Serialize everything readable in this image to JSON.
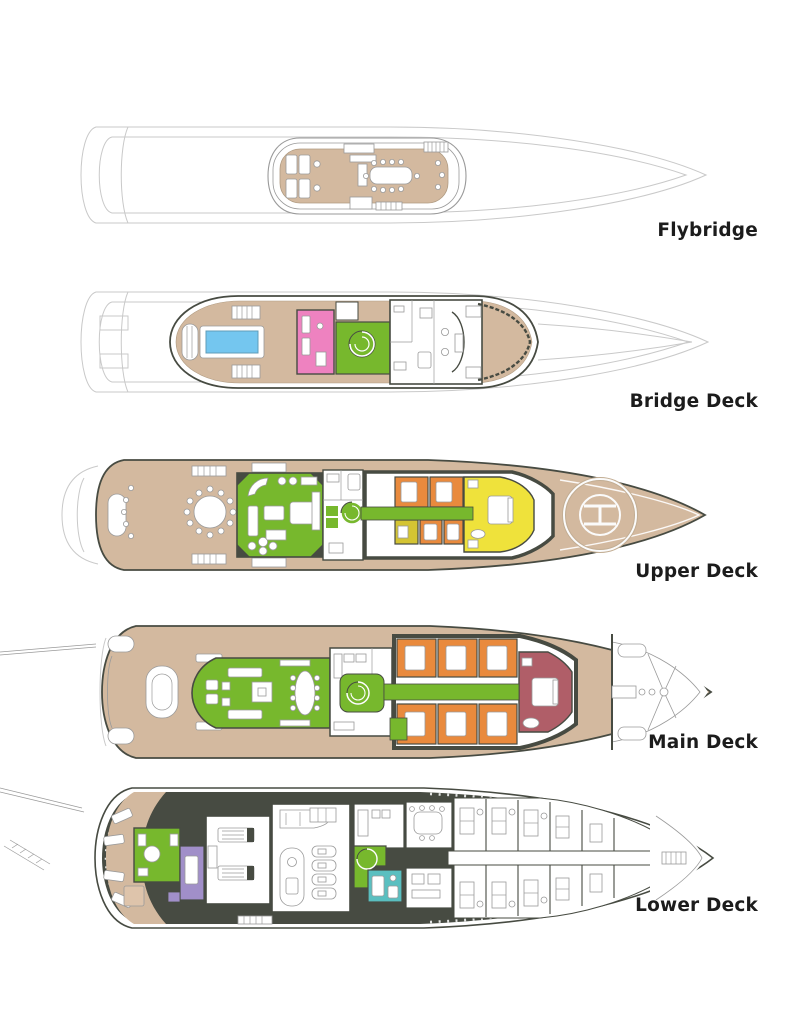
{
  "page": {
    "title": "Yacht deck plans",
    "background": "#ffffff"
  },
  "palette": {
    "ghost": "#c9c9c9",
    "line": "#9a9a9a",
    "wall": "#474b42",
    "teak": "#d3b99f",
    "teakd": "#b09b82",
    "green": "#77b82d",
    "pink": "#ee82c0",
    "orange": "#e98a3d",
    "yellow": "#efe23b",
    "olive": "#d4c433",
    "maroon": "#b05e68",
    "purple": "#a18fc9",
    "teal": "#5abfc0",
    "pool": "#74c6ef",
    "tanbox": "#dec4ab",
    "label": "#1c1c1c"
  },
  "decks": [
    {
      "label": "Flybridge"
    },
    {
      "label": "Bridge Deck"
    },
    {
      "label": "Upper Deck"
    },
    {
      "label": "Main Deck"
    },
    {
      "label": "Lower Deck"
    }
  ]
}
